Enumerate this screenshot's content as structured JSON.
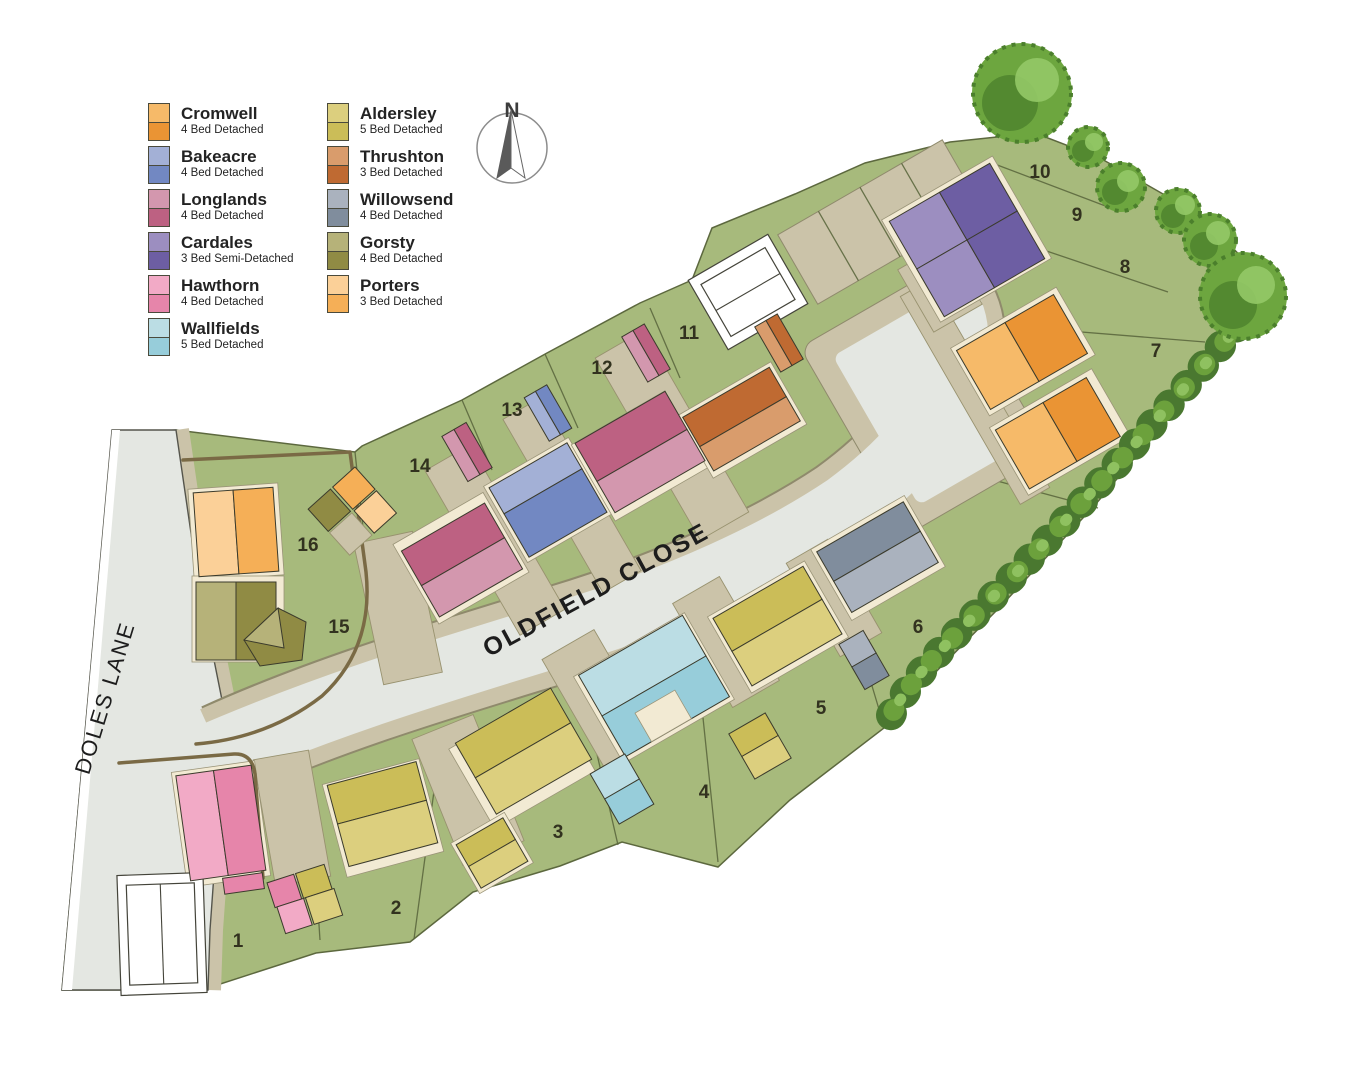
{
  "legend": {
    "items": [
      {
        "name": "Cromwell",
        "spec": "4 Bed Detached",
        "color_light": "#F6BA69",
        "color_dark": "#EA9434"
      },
      {
        "name": "Bakeacre",
        "spec": "4 Bed Detached",
        "color_light": "#A3B0D6",
        "color_dark": "#7288C2"
      },
      {
        "name": "Longlands",
        "spec": "4 Bed Detached",
        "color_light": "#D397AE",
        "color_dark": "#BD6182"
      },
      {
        "name": "Cardales",
        "spec": "3 Bed Semi-Detached",
        "color_light": "#9C8EC0",
        "color_dark": "#6D5EA3"
      },
      {
        "name": "Hawthorn",
        "spec": "4 Bed Detached",
        "color_light": "#F2AAC6",
        "color_dark": "#E685AA"
      },
      {
        "name": "Wallfields",
        "spec": "5 Bed Detached",
        "color_light": "#BBDDE4",
        "color_dark": "#97CDDA"
      },
      {
        "name": "Aldersley",
        "spec": "5 Bed Detached",
        "color_light": "#DCCF7E",
        "color_dark": "#CBBD58"
      },
      {
        "name": "Thrushton",
        "spec": "3 Bed Detached",
        "color_light": "#D99C6C",
        "color_dark": "#BF6A32"
      },
      {
        "name": "Willowsend",
        "spec": "4 Bed Detached",
        "color_light": "#AAB2BE",
        "color_dark": "#808D9D"
      },
      {
        "name": "Gorsty",
        "spec": "4 Bed Detached",
        "color_light": "#B6B279",
        "color_dark": "#908B44"
      },
      {
        "name": "Porters",
        "spec": "3 Bed Detached",
        "color_light": "#FBD098",
        "color_dark": "#F5AF57"
      }
    ]
  },
  "roads": {
    "main_label": "OLDFIELD CLOSE",
    "side_label": "DOLES LANE"
  },
  "compass": {
    "north_label": "N"
  },
  "plot_numbers": [
    "1",
    "2",
    "3",
    "4",
    "5",
    "6",
    "7",
    "8",
    "9",
    "10",
    "11",
    "12",
    "13",
    "14",
    "15",
    "16"
  ],
  "map_colors": {
    "green": "#A7BA7C",
    "green_line": "#5C683E",
    "road_grey": "#E4E7E2",
    "pavement": "#CBC3A9",
    "cream": "#F2EAD3",
    "fence": "#7A6A45",
    "outline": "#3B3B2C",
    "hedge_dark": "#4A7830",
    "hedge_mid": "#6CA13C",
    "hedge_light": "#8FC160",
    "tree_dark": "#4B7F2C",
    "tree_mid": "#6DA63F",
    "tree_light": "#94C967"
  }
}
